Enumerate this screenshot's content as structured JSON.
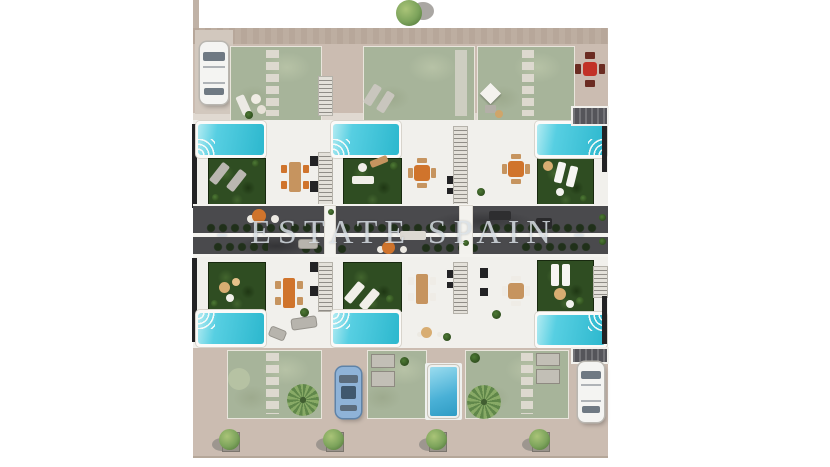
{
  "watermark": {
    "text": "- ESTATE SPAIN -"
  },
  "palette": {
    "roof_tan": "#cbbcb1",
    "roof_edge": "#b7a79a",
    "path_light": "#d2c8be",
    "garden_sage": "#a7b49a",
    "stepping_stone": "#ddd9cf",
    "grass_dark": "#2f4d22",
    "pool_cyan": "#57cfe2",
    "pool_deep": "#2fb9cf",
    "pool_blue": "#49b0d6",
    "terrace_white": "#f1f0ec",
    "band_dark": "#4a4a4d",
    "hedge_dark": "#20301a",
    "rail_white": "#f4f3ef",
    "table_orange": "#d0742c",
    "table_red": "#c23227",
    "wood_tan": "#c6945f",
    "car_blue": "#8fb3d8",
    "car_white": "#f4f4f2",
    "tree_green": "#7ca35b",
    "planter_gray": "#c2bfb6",
    "wall_dark": "#232325"
  }
}
